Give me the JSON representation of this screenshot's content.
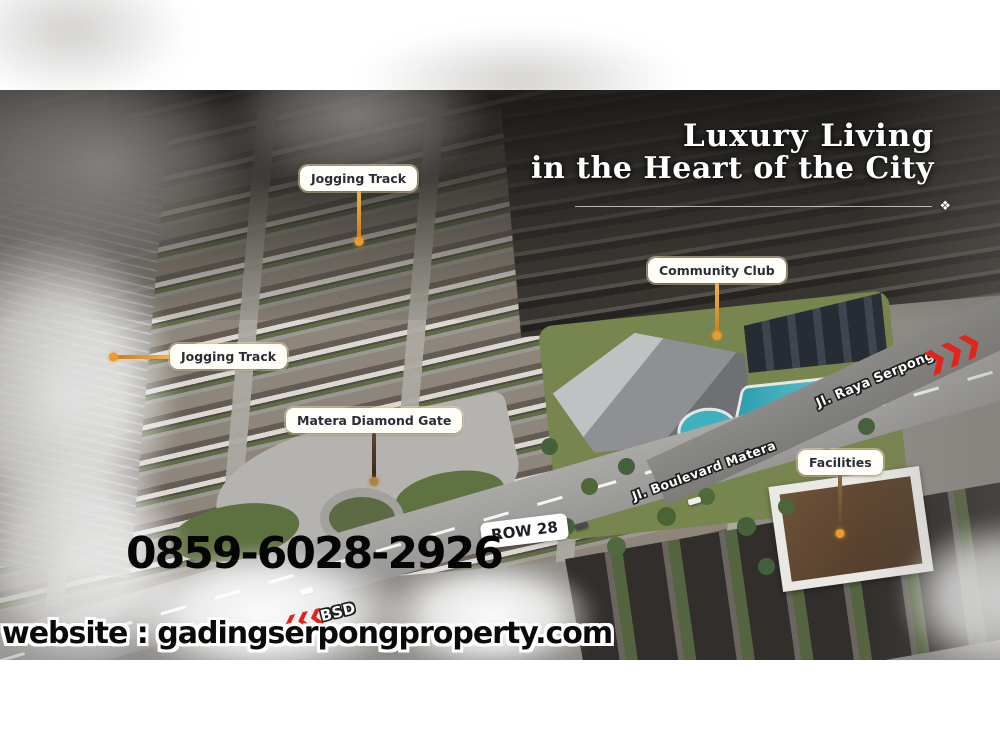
{
  "headline": {
    "line1": "Luxury Living",
    "line2": "in the Heart of the City",
    "ornament": "❖"
  },
  "pins": {
    "jogging_track_top": {
      "label": "Jogging Track"
    },
    "jogging_track_left": {
      "label": "Jogging Track"
    },
    "community_club": {
      "label": "Community Club"
    },
    "matera_diamond_gate": {
      "label": "Matera Diamond Gate"
    },
    "facilities": {
      "label": "Facilities"
    }
  },
  "roads": {
    "raya_serpong": "Jl. Raya Serpong",
    "boulevard_matera": "Jl. Boulevard Matera",
    "row_28": "ROW 28",
    "bsd": "BSD"
  },
  "contact": {
    "phone": "0859-6028-2926",
    "website": "website : gadingserpongproperty.com"
  },
  "colors": {
    "chevron_red": "#e2251c",
    "pin_orange": "#e5a13f",
    "pin_brown": "#6b4f35",
    "label_text": "#2c2c38",
    "label_bg": "#fffdf8",
    "headline_white": "#ffffff",
    "pool_blue": "#3fb0bd",
    "phone_black": "#050505"
  }
}
